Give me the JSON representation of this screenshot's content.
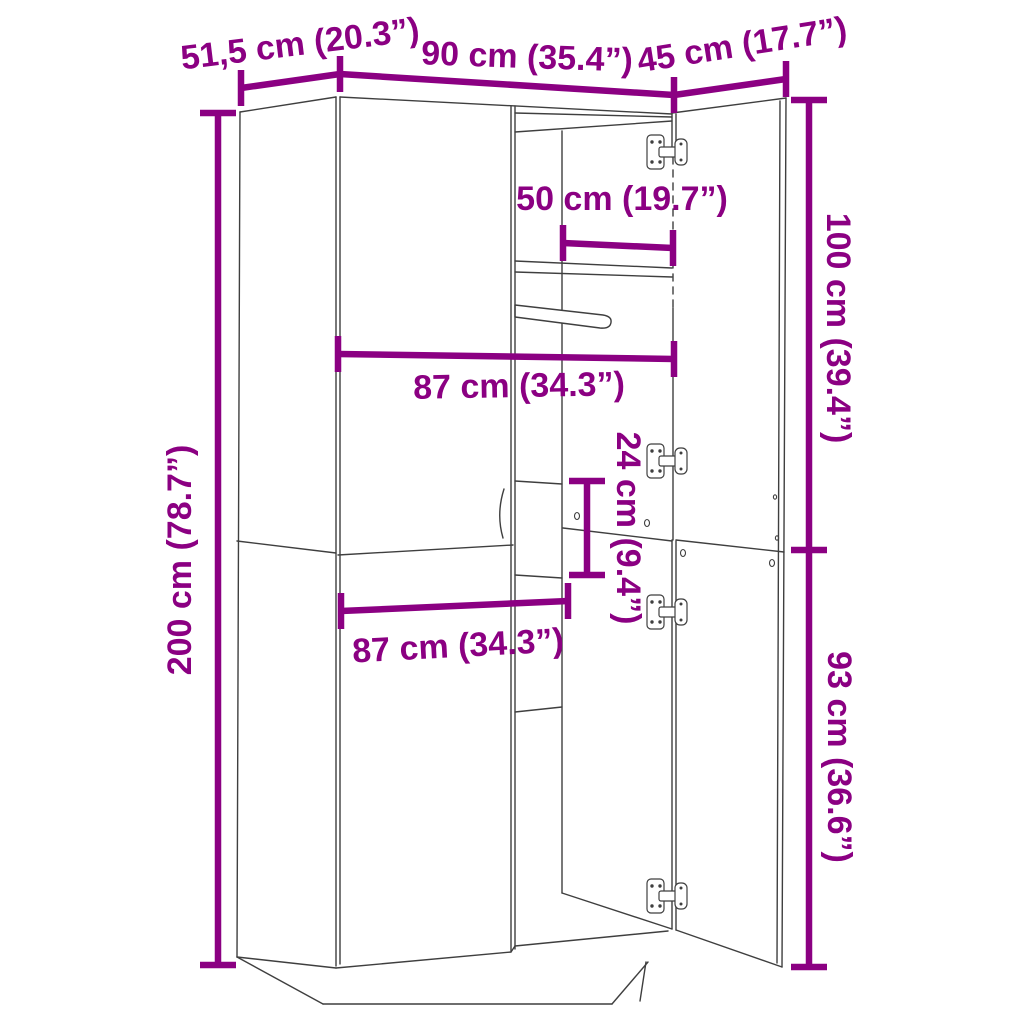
{
  "diagram": {
    "type": "furniture-dimension-diagram",
    "subject": "wardrobe with two open right doors, interior shelves and clothes rail",
    "background": "#FFFFFF",
    "accent_color": "#8B0082",
    "line_color": "#3F3F3F",
    "dimensions": {
      "depth": {
        "label": "51,5 cm (20.3”)"
      },
      "width_total": {
        "label": "90 cm (35.4”)"
      },
      "door_width": {
        "label": "45 cm (17.7”)"
      },
      "inner_top_width": {
        "label": "50 cm (19.7”)"
      },
      "inner_width_upper": {
        "label": "87 cm (34.3”)"
      },
      "compartment_height": {
        "label": "24 cm (9.4”)"
      },
      "upper_section_height": {
        "label": "100 cm (39.4”)"
      },
      "inner_width_lower": {
        "label": "87 cm (34.3”)"
      },
      "lower_section_height": {
        "label": "93 cm (36.6”)"
      },
      "total_height": {
        "label": "200 cm (78.7”)"
      }
    }
  }
}
